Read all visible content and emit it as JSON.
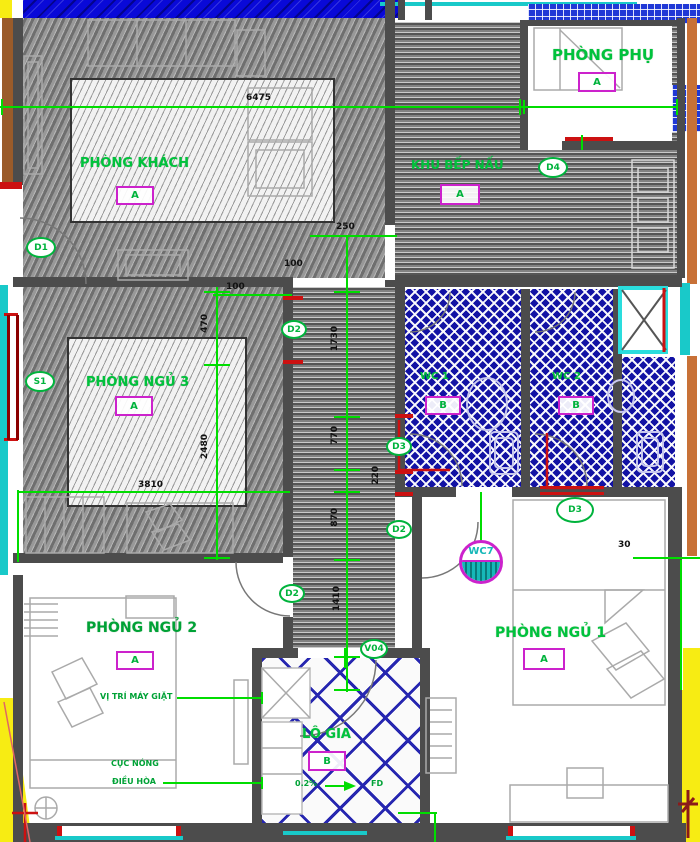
{
  "rooms": {
    "living": {
      "label": "PHÒNG KHÁCH",
      "tag": "A"
    },
    "kitchen": {
      "label": "KHU BẾP NẤU",
      "tag": "A"
    },
    "utility": {
      "label": "PHÒNG PHỤ",
      "tag": "A"
    },
    "bedroom3": {
      "label": "PHÒNG NGỦ 3",
      "tag": "A"
    },
    "bedroom2": {
      "label": "PHÒNG NGỦ 2",
      "tag": "A"
    },
    "bedroom1": {
      "label": "PHÒNG NGỦ 1",
      "tag": "A"
    },
    "wc1": {
      "label": "WC 1",
      "tag": "B"
    },
    "wc2": {
      "label": "WC 2",
      "tag": "B"
    },
    "loggia": {
      "label": "LÔ GIA",
      "tag": "B"
    }
  },
  "markers": {
    "d1": "D1",
    "d2_top": "D2",
    "d2_mid": "D2",
    "d2_low": "D2",
    "d3_mid": "D3",
    "d3_room": "D3",
    "d4": "D4",
    "s1": "S1",
    "v04": "V04",
    "wc7": "WC7"
  },
  "dims": {
    "total": "6475",
    "c250": "250",
    "c100": "100",
    "b100": "100",
    "v1730": "1730",
    "v770": "770",
    "v220": "220",
    "v870": "870",
    "v1410": "1410",
    "b470": "470",
    "b2480": "2480",
    "b3810": "3810",
    "r30": "30"
  },
  "notes": {
    "washer": "VỊ TRÍ MÁY GIẶT",
    "ac1": "CỤC NÓNG",
    "ac2": "ĐIỀU HÒA",
    "slope": "0.2%",
    "fd": "FD"
  },
  "colors": {
    "wall": "#4c4c4c",
    "label_green": "#00c23c",
    "dim_green": "#00dd00",
    "magenta": "#cc22cc",
    "wc_blue": "#1212a4",
    "facade_blue": "#0909d8",
    "teal": "#19c9c9",
    "orange": "#c87137",
    "yellow": "#f7ec13",
    "red": "#cc1111"
  }
}
